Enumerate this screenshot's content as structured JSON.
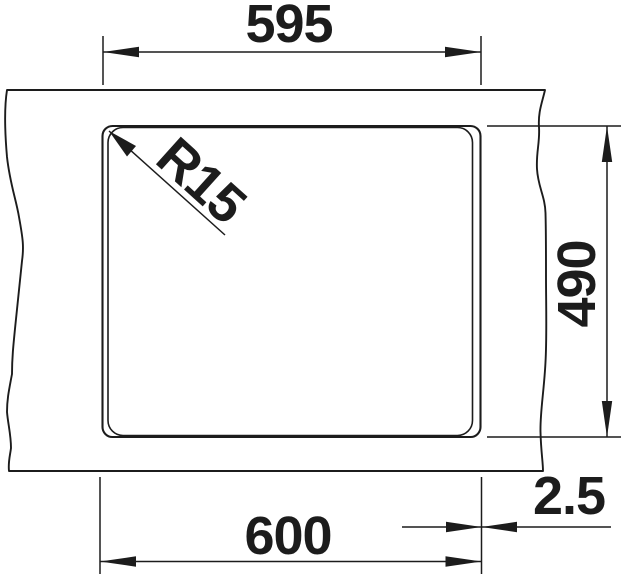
{
  "drawing": {
    "type": "sink-cutout-installation-drawing",
    "dimensions": {
      "cutout_width": "595",
      "overall_width": "600",
      "cutout_depth": "490",
      "rim_overhang": "2.5",
      "corner_radius": "R15"
    },
    "colors": {
      "line": "#1c1c1c",
      "background": "#ffffff"
    }
  }
}
